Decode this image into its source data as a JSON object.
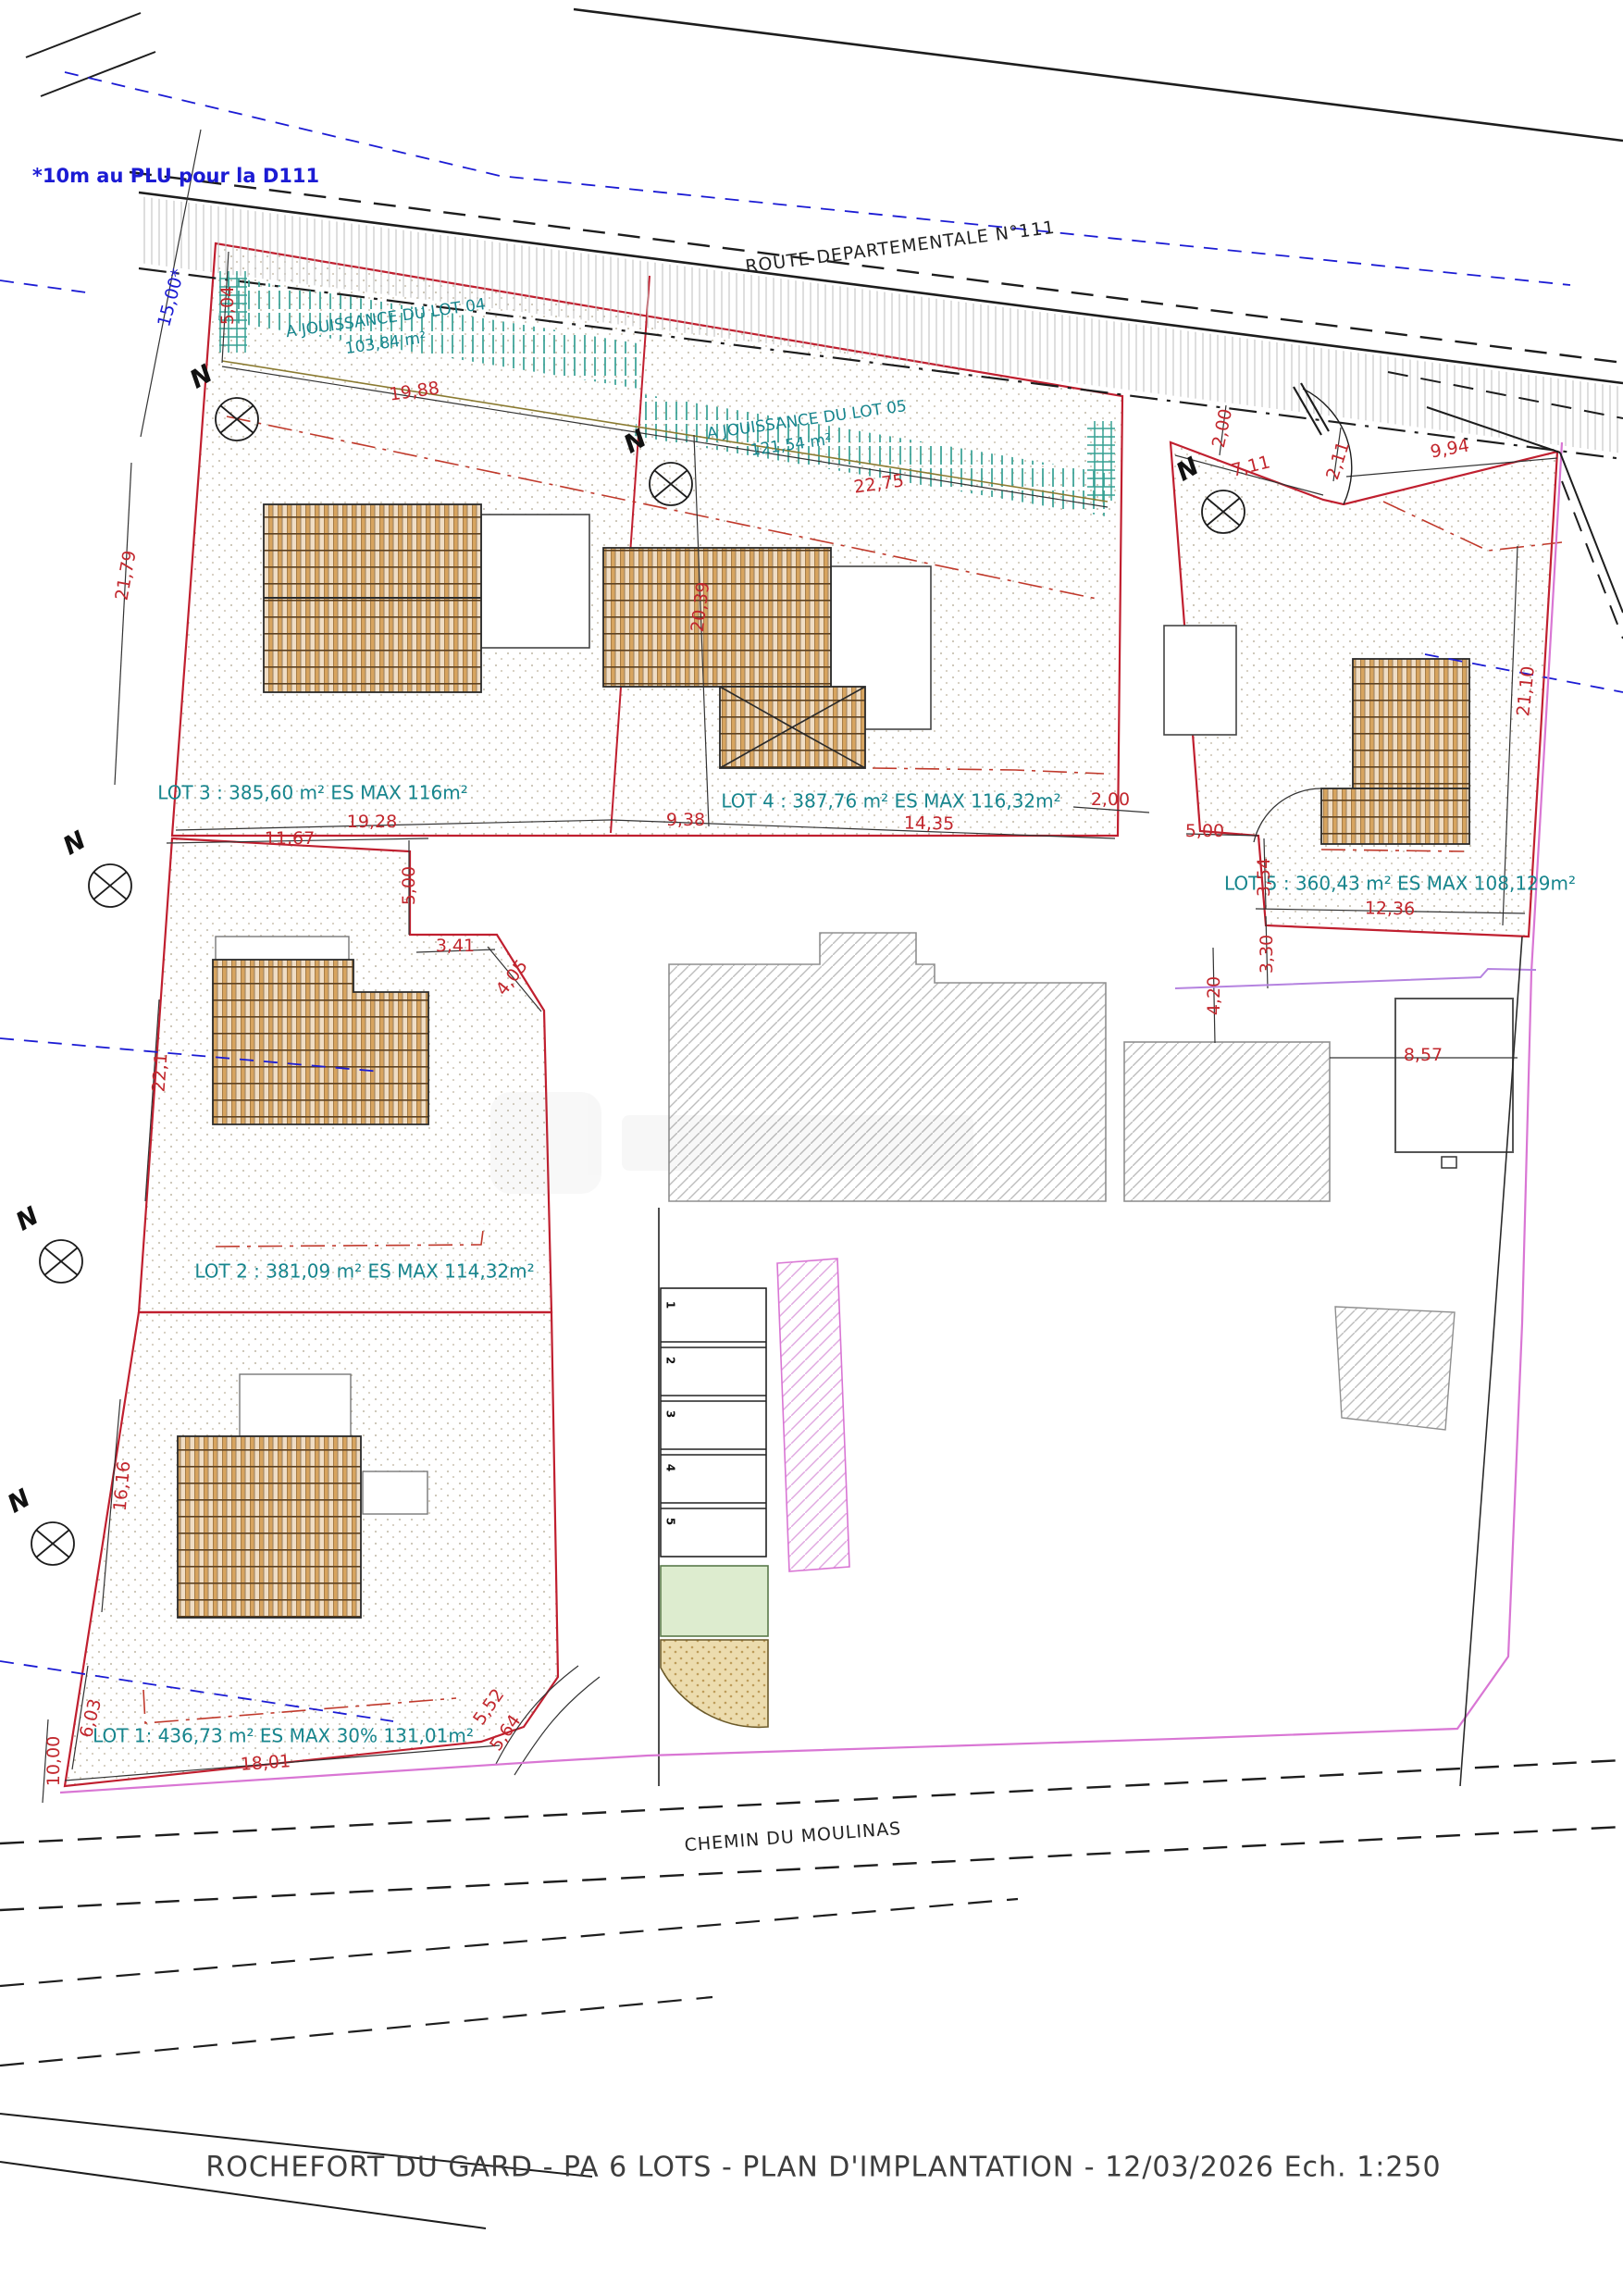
{
  "title": "ROCHEFORT DU GARD - PA 6 LOTS - PLAN D'IMPLANTATION - 12/03/2026  Ech. 1:250",
  "note_plu": "*10m au PLU pour la D111",
  "north_letter": "N",
  "roads": {
    "route": "ROUTE DEPARTEMENTALE N°111",
    "chemin": "CHEMIN DU MOULINAS"
  },
  "jouissance": {
    "lot04_label": "A JOUISSANCE DU LOT 04",
    "lot04_area": "103,84 m²",
    "lot05_label": "A JOUISSANCE DU LOT 05",
    "lot05_area": "121,54 m²"
  },
  "lots": {
    "lot1": "LOT 1: 436,73 m² ES MAX 30% 131,01m²",
    "lot2": "LOT 2 : 381,09 m² ES MAX 114,32m²",
    "lot3": "LOT 3 : 385,60 m² ES MAX 116m²",
    "lot4": "LOT 4 : 387,76 m² ES MAX 116,32m²",
    "lot5": "LOT 5 : 360,43 m² ES MAX 108,129m²"
  },
  "dims": {
    "d15_00": "15,00*",
    "d5_04": "5,04",
    "d19_88": "19,88",
    "d22_75": "22,75",
    "d21_79": "21,79",
    "d2_00a": "2,00",
    "d7_11": "7,11",
    "d2_11": "2,11",
    "d9_94": "9,94",
    "d21_10": "21,10",
    "d20_39": "20,39",
    "d19_28": "19,28",
    "d9_38": "9,38",
    "d14_35": "14,35",
    "d2_00b": "2,00",
    "d5_00b": "5,00",
    "d11_67": "11,67",
    "d5_00a": "5,00",
    "d3_41": "3,41",
    "d4_05": "4,05",
    "d3_54": "3,54",
    "d12_36": "12,36",
    "d3_30": "3,30",
    "d4_20": "4,20",
    "d8_57": "8,57",
    "d22_1": "22,1",
    "d16_16": "16,16",
    "d6_03": "6,03",
    "d10_00": "10,00",
    "d18_01": "18,01",
    "d5_52": "5,52",
    "d5_64": "5,64"
  },
  "parking": {
    "s1": "1",
    "s2": "2",
    "s3": "3",
    "s4": "4",
    "s5": "5"
  },
  "colors": {
    "boundary_red": "#c01f2f",
    "teal": "#17858d",
    "blue": "#1b1bd4",
    "magenta": "#d976d4",
    "roof_tan": "#d7a45f",
    "green_zone": "#ddeccf"
  }
}
